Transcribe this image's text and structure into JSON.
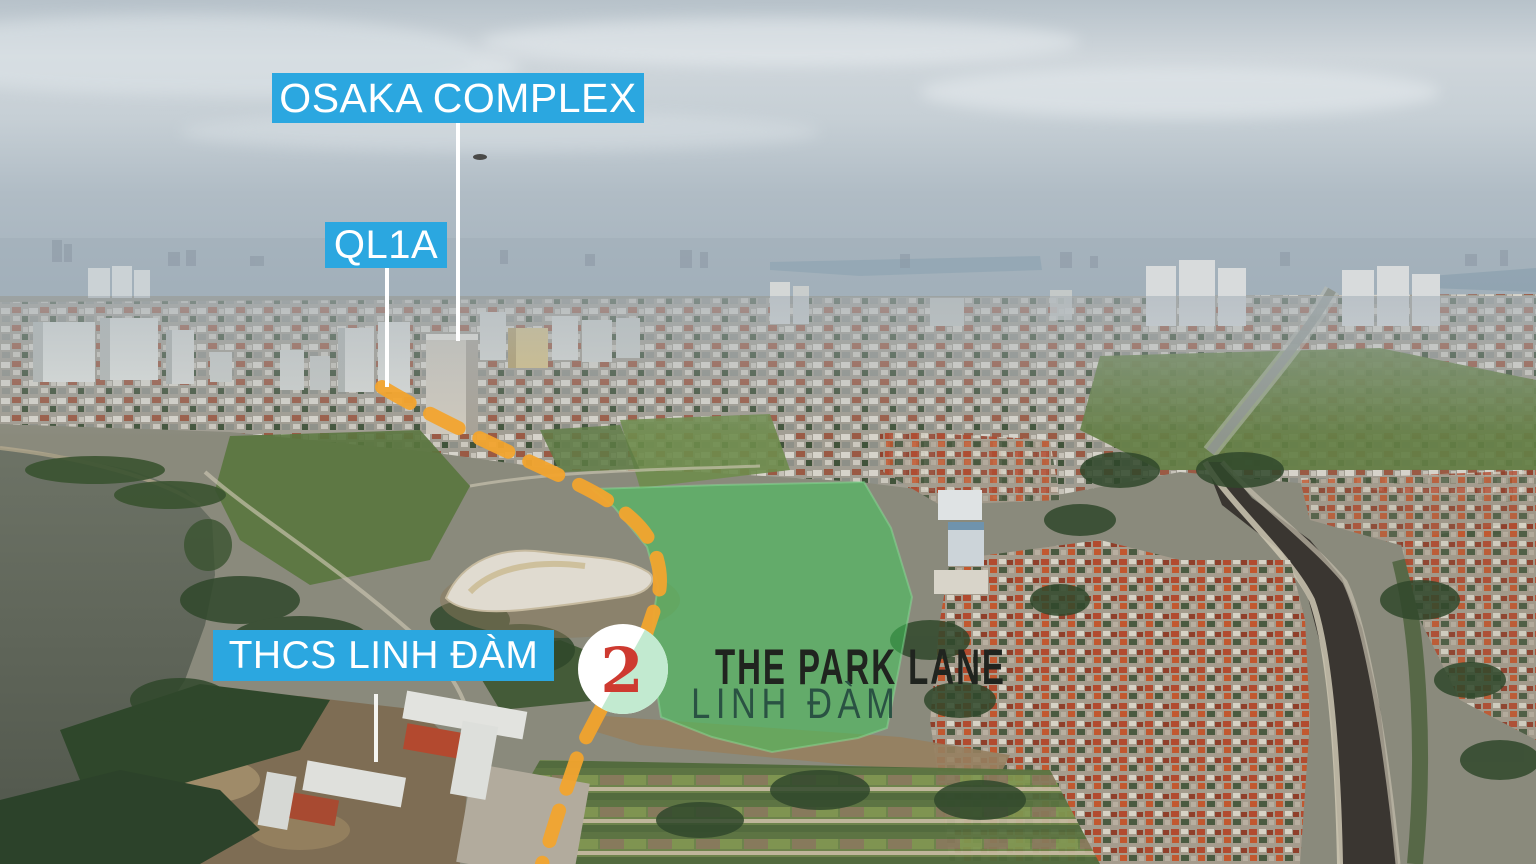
{
  "labels": {
    "osaka": "OSAKA COMPLEX",
    "ql1a": "QL1A",
    "thcs": "THCS LINH ĐÀM"
  },
  "marker": {
    "number": "2"
  },
  "project": {
    "name_line1": "THE PARK LANE",
    "name_line2": "LINH ĐÀM"
  },
  "colors": {
    "label_bg": "#2BA7E0",
    "label_text": "#FFFFFF",
    "route_dash": "#F2A42E",
    "site_fill": "#3FCA5A",
    "marker_circle": "#FFFFFF",
    "marker_half": "#C2EAD0",
    "marker_number": "#CE3A30",
    "project_title": "#20241F",
    "project_subtitle": "#2A5243"
  }
}
